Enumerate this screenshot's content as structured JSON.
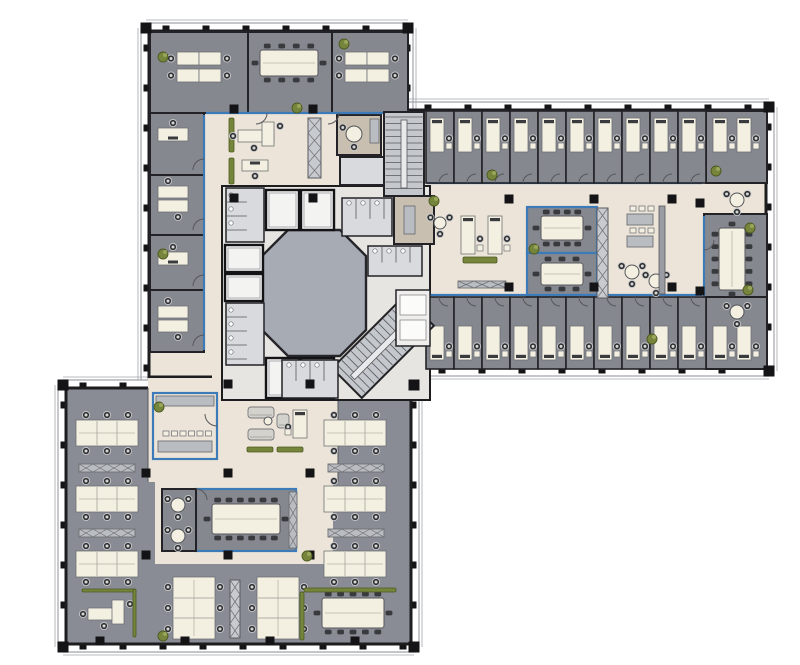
{
  "meta": {
    "type": "architectural-floor-plan",
    "description": "Office tower typical floor plan: three wings (north, east, south-west) around a central elevator core with octagonal lobby, cellular offices, open-plan desk clusters, meeting rooms, cafe and lounges",
    "canvas": {
      "width": 800,
      "height": 665
    }
  },
  "palette": {
    "background": "#ffffff",
    "wall": "#1d1d20",
    "facade_line": "#a2a5aa",
    "office_floor": "#85888f",
    "open_gray_floor": "#898c94",
    "beige_floor": "#ece4d8",
    "tan_floor": "#c9bfb0",
    "wc_floor": "#d8dade",
    "core_floor": "#e7e5e1",
    "lobby_floor": "#a7acb4",
    "stair_floor": "#c4c8cd",
    "glass_blue": "#3d7ab8",
    "desk": "#f3f0e2",
    "desk_edge": "#6f7176",
    "chair_dark": "#303134",
    "chair_light": "#d6d6d4",
    "cabinet": "#b9bcc1",
    "shelf": "#c7cacf",
    "wallbar": "#999ca3",
    "plant": "#76853c",
    "plant_dark": "#4c5a21",
    "column": "#141417",
    "elevator": "#f3f3f2",
    "store": "#efeeec"
  },
  "facade_segments": [
    [
      146,
      28,
      408,
      28,
      "n"
    ],
    [
      146,
      28,
      146,
      380,
      "w"
    ],
    [
      408,
      28,
      408,
      110,
      "e"
    ],
    [
      408,
      107,
      769,
      107,
      "n"
    ],
    [
      769,
      107,
      769,
      371,
      "e"
    ],
    [
      422,
      371,
      769,
      371,
      "s"
    ],
    [
      63,
      385,
      148,
      385,
      "n"
    ],
    [
      330,
      385,
      414,
      385,
      "n"
    ],
    [
      63,
      385,
      63,
      647,
      "w"
    ],
    [
      63,
      647,
      414,
      647,
      "s"
    ],
    [
      414,
      385,
      414,
      647,
      "e"
    ]
  ],
  "corner_blocks": [
    [
      146,
      28
    ],
    [
      408,
      28
    ],
    [
      769,
      107
    ],
    [
      769,
      371
    ],
    [
      63,
      385
    ],
    [
      63,
      647
    ],
    [
      414,
      647
    ],
    [
      414,
      385
    ]
  ],
  "zones": [
    {
      "name": "wing-a-open-area",
      "x": 149,
      "y": 31,
      "w": 257,
      "h": 346,
      "fill": "beige_floor"
    },
    {
      "name": "wing-b-corridor",
      "x": 400,
      "y": 110,
      "w": 366,
      "h": 258,
      "fill": "beige_floor"
    },
    {
      "name": "wing-c-open-plan",
      "x": 66,
      "y": 388,
      "w": 345,
      "h": 256,
      "fill": "open_gray_floor"
    }
  ],
  "wall_rects": [
    {
      "name": "wing-a-shell",
      "x": 149,
      "y": 31,
      "w": 257,
      "h": 346
    },
    {
      "name": "wing-b-shell",
      "x": 400,
      "y": 110,
      "w": 366,
      "h": 258
    },
    {
      "name": "wing-c-shell",
      "x": 66,
      "y": 388,
      "w": 345,
      "h": 256
    }
  ],
  "overlays": [
    {
      "name": "wing-c-lounge-zone",
      "x": 148,
      "y": 378,
      "w": 190,
      "h": 104,
      "fill": "beige_floor",
      "edge": 1
    },
    {
      "name": "wing-c-meeting-zone",
      "x": 155,
      "y": 480,
      "w": 178,
      "h": 84,
      "fill": "beige_floor"
    },
    {
      "name": "corridor-opening-south",
      "x": 212,
      "y": 370,
      "w": 118,
      "h": 24,
      "fill": "beige_floor"
    },
    {
      "name": "corridor-opening-east",
      "x": 394,
      "y": 186,
      "w": 14,
      "h": 110,
      "fill": "beige_floor"
    }
  ],
  "core": {
    "x": 222,
    "y": 186,
    "w": 208,
    "h": 214,
    "lobby_polygon": [
      [
        288,
        230
      ],
      [
        340,
        230
      ],
      [
        366,
        256
      ],
      [
        366,
        330
      ],
      [
        340,
        356
      ],
      [
        288,
        356
      ],
      [
        262,
        330
      ],
      [
        262,
        256
      ]
    ]
  },
  "rooms": [
    {
      "name": "office",
      "x": 150,
      "y": 32,
      "w": 98,
      "h": 81,
      "f": "office_floor"
    },
    {
      "name": "conference-room",
      "x": 248,
      "y": 32,
      "w": 84,
      "h": 81,
      "f": "office_floor"
    },
    {
      "name": "office",
      "x": 332,
      "y": 32,
      "w": 76,
      "h": 81,
      "f": "office_floor"
    },
    {
      "name": "office",
      "x": 150,
      "y": 113,
      "w": 54,
      "h": 62,
      "f": "office_floor"
    },
    {
      "name": "office",
      "x": 150,
      "y": 175,
      "w": 54,
      "h": 60,
      "f": "office_floor"
    },
    {
      "name": "office",
      "x": 150,
      "y": 235,
      "w": 54,
      "h": 55,
      "f": "office_floor"
    },
    {
      "name": "office",
      "x": 150,
      "y": 290,
      "w": 54,
      "h": 62,
      "f": "office_floor"
    },
    {
      "name": "meeting-room",
      "x": 337,
      "y": 115,
      "w": 44,
      "h": 40,
      "f": "tan_floor"
    },
    {
      "name": "wc-room",
      "x": 340,
      "y": 157,
      "w": 44,
      "h": 28,
      "f": "wc_floor"
    },
    {
      "name": "utility-room",
      "x": 394,
      "y": 196,
      "w": 40,
      "h": 48,
      "f": "tan_floor"
    },
    {
      "name": "meeting-room",
      "x": 527,
      "y": 207,
      "w": 70,
      "h": 46,
      "f": "office_floor",
      "glass": 1
    },
    {
      "name": "meeting-room",
      "x": 527,
      "y": 253,
      "w": 70,
      "h": 46,
      "f": "office_floor",
      "glass": 1
    },
    {
      "name": "conference-room",
      "x": 704,
      "y": 214,
      "w": 63,
      "h": 92,
      "f": "office_floor"
    },
    {
      "name": "office",
      "x": 706,
      "y": 111,
      "w": 61,
      "h": 72,
      "f": "office_floor"
    },
    {
      "name": "office",
      "x": 706,
      "y": 297,
      "w": 61,
      "h": 72,
      "f": "office_floor"
    },
    {
      "name": "cafe",
      "x": 153,
      "y": 393,
      "w": 64,
      "h": 66,
      "f": "beige_floor",
      "glass": 1
    },
    {
      "name": "conference-room",
      "x": 196,
      "y": 489,
      "w": 100,
      "h": 62,
      "f": "office_floor",
      "glass": 1
    },
    {
      "name": "lounge-room",
      "x": 162,
      "y": 489,
      "w": 34,
      "h": 62,
      "f": "office_floor"
    }
  ],
  "office_rows": [
    {
      "x0": 426,
      "step": 28,
      "count": 10,
      "y": 111,
      "h": 72,
      "desk_y": 118,
      "monitor": "n",
      "door": "s"
    },
    {
      "x0": 426,
      "step": 28,
      "count": 10,
      "y": 297,
      "h": 72,
      "desk_y": 326,
      "monitor": "s",
      "door": "n"
    }
  ],
  "corner_office_desks": [
    [
      720,
      118
    ],
    [
      744,
      118
    ],
    [
      720,
      326
    ],
    [
      744,
      326
    ]
  ],
  "furniture": [
    [
      "cluster22",
      177,
      52
    ],
    [
      "confh",
      260,
      50,
      58,
      26,
      10
    ],
    [
      "cluster22",
      345,
      52
    ],
    [
      "hdesk",
      158,
      128,
      30,
      13,
      "n"
    ],
    [
      "pairh",
      158,
      186
    ],
    [
      "hdesk",
      158,
      252,
      30,
      13,
      "n"
    ],
    [
      "pairh",
      158,
      306
    ],
    [
      "shelf",
      308,
      118,
      13,
      60
    ],
    [
      "bench",
      229,
      118,
      5,
      34
    ],
    [
      "bench",
      229,
      158,
      5,
      26
    ],
    [
      "ldesk",
      238,
      122
    ],
    [
      "hdesk",
      242,
      160,
      26,
      11,
      "s"
    ],
    [
      "round",
      354,
      134,
      8,
      2
    ],
    [
      "counter",
      370,
      119,
      9,
      24
    ],
    [
      "wc",
      226,
      188,
      38,
      54
    ],
    [
      "elev",
      225,
      245,
      38,
      27
    ],
    [
      "elev",
      225,
      274,
      38,
      27
    ],
    [
      "wc",
      226,
      303,
      38,
      62
    ],
    [
      "elev",
      266,
      190,
      33,
      40
    ],
    [
      "elev",
      301,
      190,
      33,
      40
    ],
    [
      "elev",
      266,
      358,
      33,
      40
    ],
    [
      "elev",
      301,
      358,
      33,
      40
    ],
    [
      "wc",
      342,
      198,
      50,
      38
    ],
    [
      "counter",
      404,
      206,
      11,
      28
    ],
    [
      "wc",
      368,
      246,
      54,
      30
    ],
    [
      "stair",
      384,
      112,
      40,
      84,
      0
    ],
    [
      "stair",
      362,
      296,
      42,
      102,
      45
    ],
    [
      "store",
      396,
      290,
      34,
      56
    ],
    [
      "wc",
      282,
      360,
      56,
      38
    ],
    [
      "confh",
      541,
      216,
      42,
      24,
      10
    ],
    [
      "confh",
      541,
      263,
      42,
      22,
      8
    ],
    [
      "shelf",
      597,
      208,
      11,
      90
    ],
    [
      "counter",
      627,
      214,
      26,
      11
    ],
    [
      "stools",
      630,
      206,
      3,
      9
    ],
    [
      "counter",
      627,
      236,
      26,
      11
    ],
    [
      "stools",
      630,
      228,
      3,
      9
    ],
    [
      "round",
      632,
      272,
      7,
      3
    ],
    [
      "round",
      656,
      281,
      7,
      3
    ],
    [
      "wallbar",
      659,
      206,
      6,
      88
    ],
    [
      "confv",
      719,
      228,
      26,
      62,
      12
    ],
    [
      "round",
      737,
      200,
      7,
      3
    ],
    [
      "round",
      737,
      312,
      7,
      3
    ],
    [
      "vdeskf",
      468,
      216,
      38,
      "n",
      "e"
    ],
    [
      "vdeskf",
      495,
      216,
      38,
      "n",
      "e"
    ],
    [
      "bench",
      463,
      257,
      34,
      6
    ],
    [
      "counterX",
      458,
      281,
      48,
      7
    ],
    [
      "round",
      440,
      223,
      6,
      3
    ],
    [
      "cluster32",
      76,
      411
    ],
    [
      "cluster32",
      76,
      477
    ],
    [
      "cluster32",
      76,
      542
    ],
    [
      "cluster32",
      324,
      411
    ],
    [
      "cluster32",
      324,
      477
    ],
    [
      "cluster32",
      324,
      542
    ],
    [
      "counterX",
      79,
      464,
      56,
      8
    ],
    [
      "counterX",
      79,
      529,
      56,
      8
    ],
    [
      "counterX",
      328,
      464,
      56,
      8
    ],
    [
      "counterX",
      328,
      529,
      56,
      8
    ],
    [
      "counter",
      156,
      396,
      58,
      10
    ],
    [
      "counter",
      158,
      441,
      54,
      11
    ],
    [
      "stools",
      163,
      431,
      6,
      8.5
    ],
    [
      "sofa",
      248,
      407,
      26,
      11
    ],
    [
      "sofa",
      248,
      429,
      26,
      11
    ],
    [
      "sofa",
      277,
      414,
      12,
      14
    ],
    [
      "round",
      268,
      421,
      4,
      0
    ],
    [
      "bench",
      247,
      447,
      26,
      5
    ],
    [
      "bench",
      277,
      447,
      26,
      5
    ],
    [
      "vdeskf",
      300,
      410,
      28,
      "n",
      "w"
    ],
    [
      "confh",
      212,
      504,
      68,
      30,
      14
    ],
    [
      "round",
      178,
      505,
      7,
      3
    ],
    [
      "round",
      178,
      536,
      7,
      3
    ],
    [
      "counterX",
      289,
      492,
      8,
      56
    ],
    [
      "clusterV23",
      173,
      577
    ],
    [
      "shelf",
      230,
      580,
      10,
      58
    ],
    [
      "clusterV23",
      257,
      577
    ],
    [
      "ldesk",
      88,
      600
    ],
    [
      "confh",
      322,
      598,
      62,
      30,
      12
    ],
    [
      "hedge",
      304,
      588,
      92,
      4
    ],
    [
      "hedge",
      300,
      592,
      4,
      48
    ],
    [
      "hedge",
      82,
      589,
      54,
      3
    ],
    [
      "hedge",
      133,
      589,
      3,
      48
    ]
  ],
  "glass_lines": [
    [
      204,
      115,
      204,
      350
    ],
    [
      206,
      113,
      404,
      113
    ],
    [
      427,
      183,
      702,
      183
    ],
    [
      427,
      295,
      702,
      295
    ],
    [
      704,
      216,
      704,
      304
    ]
  ],
  "door_arcs": [
    [
      204,
      170,
      11,
      "nw"
    ],
    [
      204,
      230,
      11,
      "nw"
    ],
    [
      204,
      286,
      11,
      "nw"
    ],
    [
      204,
      346,
      11,
      "nw"
    ],
    [
      256,
      113,
      11,
      "se"
    ],
    [
      328,
      113,
      11,
      "se"
    ],
    [
      217,
      414,
      12,
      "sw"
    ],
    [
      704,
      240,
      10,
      "se"
    ],
    [
      196,
      500,
      11,
      "ne"
    ]
  ],
  "columns": [
    [
      234,
      109
    ],
    [
      313,
      109
    ],
    [
      234,
      198
    ],
    [
      313,
      198
    ],
    [
      509,
      199
    ],
    [
      594,
      199
    ],
    [
      672,
      199
    ],
    [
      509,
      287
    ],
    [
      594,
      287
    ],
    [
      672,
      287
    ],
    [
      700,
      203
    ],
    [
      700,
      291
    ],
    [
      146,
      473
    ],
    [
      228,
      473
    ],
    [
      310,
      473
    ],
    [
      146,
      555
    ],
    [
      228,
      555
    ],
    [
      310,
      555
    ],
    [
      228,
      384
    ],
    [
      310,
      384
    ],
    [
      100,
      641
    ],
    [
      185,
      641
    ],
    [
      270,
      641
    ],
    [
      355,
      641
    ]
  ],
  "plants": [
    [
      163,
      57
    ],
    [
      297,
      108
    ],
    [
      344,
      44
    ],
    [
      163,
      254
    ],
    [
      492,
      175
    ],
    [
      716,
      171
    ],
    [
      434,
      201
    ],
    [
      534,
      249
    ],
    [
      750,
      228
    ],
    [
      652,
      339
    ],
    [
      748,
      290
    ],
    [
      159,
      407
    ],
    [
      307,
      556
    ],
    [
      163,
      636
    ]
  ]
}
